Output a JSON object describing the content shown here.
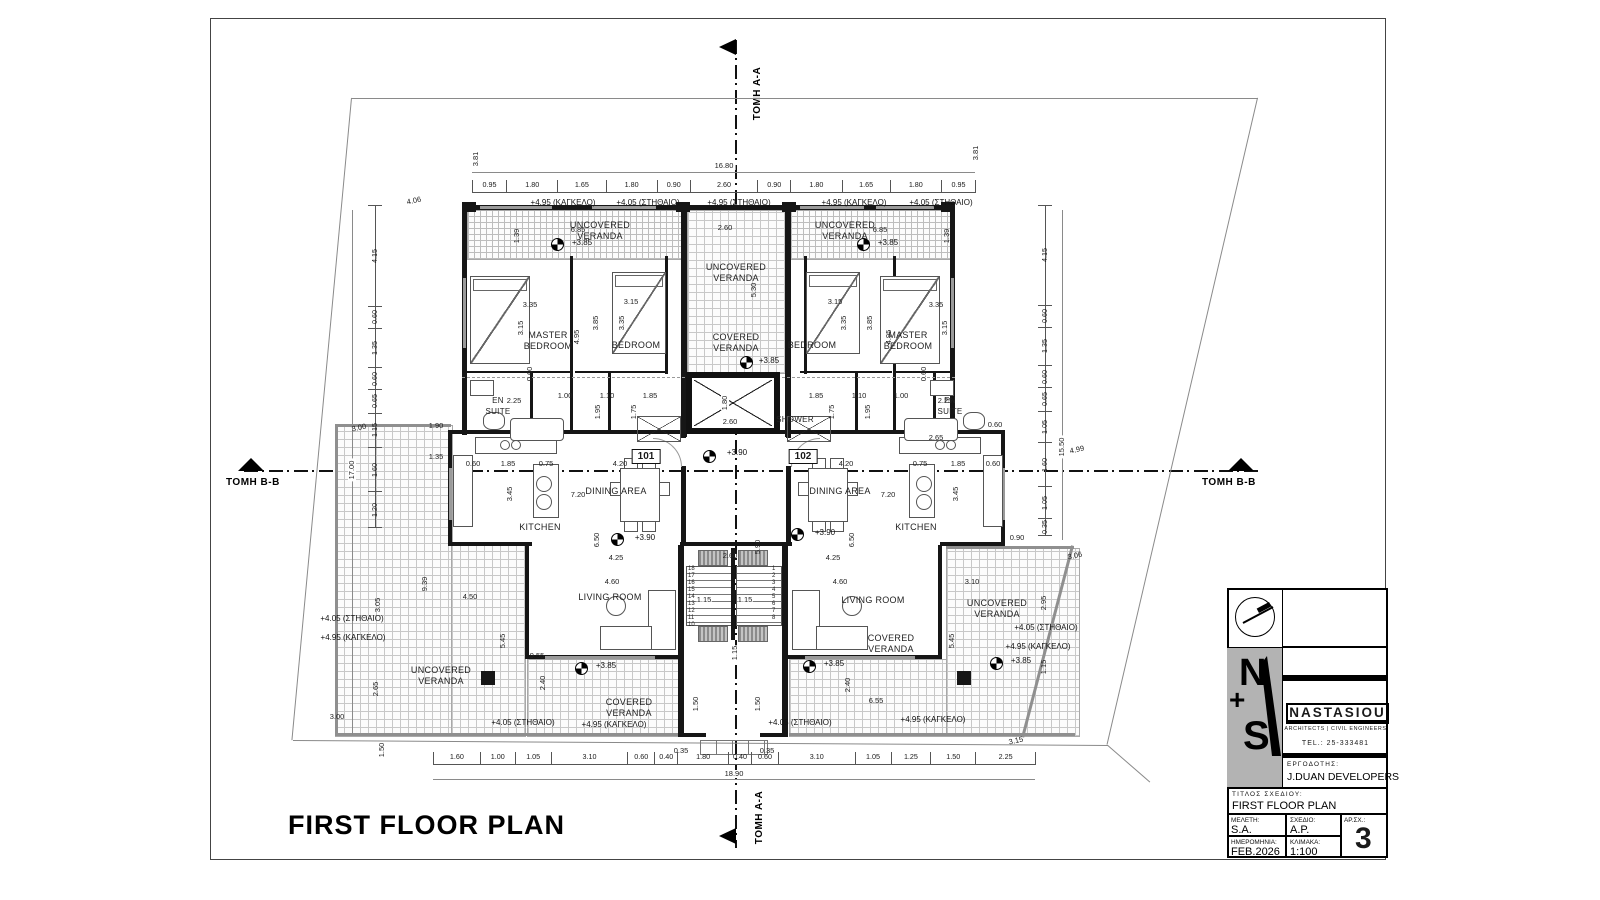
{
  "sheet": {
    "plan_title": "FIRST FLOOR PLAN",
    "section_aa": "TOMH A-A",
    "section_bb": "TOMH B-B"
  },
  "units": {
    "left": "101",
    "right": "102"
  },
  "rooms": {
    "master_bedroom": "MASTER\nBEDROOM",
    "bedroom": "BEDROOM",
    "en_suite": "EN\nSUITE",
    "shower": "SHOWER",
    "kitchen": "KITCHEN",
    "dining_area": "DINING AREA",
    "living_room": "LIVING ROOM",
    "uncovered_veranda": "UNCOVERED\nVERANDA",
    "covered_veranda": "COVERED\nVERANDA"
  },
  "levels": {
    "railing_495": "+4.95 (ΚΑΓΚΕΛΟ)",
    "parapet_405": "+4.05 (ΣΤΗΘΑΙΟ)",
    "parapet_495": "+4.95 (ΣΤΗΘΑΙΟ)",
    "lvl_385": "+3.85",
    "lvl_390": "+3.90"
  },
  "chains": {
    "top": [
      "0.95",
      "1.80",
      "1.65",
      "1.80",
      "0.90",
      "2.60",
      "0.90",
      "1.80",
      "1.65",
      "1.80",
      "0.95"
    ],
    "top_total": "16.80",
    "bottom": [
      "1.60",
      "1.00",
      "1.05",
      "3.10",
      "0.60",
      "0.40",
      "1.80",
      "0.40",
      "0.60",
      "3.10",
      "1.05",
      "1.25",
      "1.50",
      "2.25"
    ],
    "bottom_total": "18.90",
    "left": [
      "4.15",
      "0.60",
      "1.35",
      "0.60",
      "0.65",
      "1.15",
      "1.60",
      "1.20"
    ],
    "right": [
      "4.15",
      "0.60",
      "1.35",
      "0.60",
      "0.65",
      "1.05",
      "1.60",
      "1.05",
      "0.35"
    ]
  },
  "stairs": {
    "flight_down": [
      "18",
      "17",
      "16",
      "15",
      "14",
      "13",
      "12",
      "11",
      "10"
    ],
    "flight_up": [
      "1",
      "2",
      "3",
      "4",
      "5",
      "6",
      "7",
      "8"
    ]
  },
  "dims": {
    "d035": "0.35",
    "d060": "0.60",
    "d075": "0.75",
    "d090": "0.90",
    "d100": "1.00",
    "d110": "1.10",
    "d115": "1.15",
    "d135": "1.35",
    "d139": "1.39",
    "d150": "1.50",
    "d175": "1.75",
    "d180": "1.80",
    "d185": "1.85",
    "d190": "1.90",
    "d195": "1.95",
    "d225": "2.25",
    "d240": "2.40",
    "d260": "2.60",
    "d265": "2.65",
    "d295": "2.95",
    "d300": "3.00",
    "d305": "3.05",
    "d306": "3.06",
    "d310": "3.10",
    "d315": "3.15",
    "d335": "3.35",
    "d345": "3.45",
    "d381": "3.81",
    "d385": "3.85",
    "d406": "4.06",
    "d420": "4.20",
    "d425": "4.25",
    "d450": "4.50",
    "d460": "4.60",
    "d495": "4.95",
    "d499": "4.99",
    "d530": "5.30",
    "d545": "5.45",
    "d590": "5.90",
    "d650": "6.50",
    "d655": "6.55",
    "d685": "6.85",
    "d720": "7.20",
    "d939": "9.39",
    "d955": "9.55",
    "d1550": "15.50",
    "d1700": "17.00"
  },
  "title_block": {
    "logo_n": "N",
    "logo_plus": "+",
    "logo_s": "S",
    "firm_name": "NASTASIOU",
    "firm_subtitle": "ARCHITECTS | CIVIL ENGINEERS",
    "tel": "TEL.: 25-333481",
    "client_label": "ΕΡΓΟΔΟΤΗΣ:",
    "client_name": "J.DUAN DEVELOPERS",
    "title_label": "ΤΙΤΛΟΣ ΣΧΕΔΙΟΥ:",
    "title_value": "FIRST FLOOR PLAN",
    "study_label": "ΜΕΛΕΤΗ:",
    "study_value": "S.A.",
    "drawn_label": "ΣΧΕΔΙΟ:",
    "drawn_value": "A.P.",
    "sheet_no_label": "ΑΡ.ΣΧ.:",
    "sheet_no_value": "3",
    "date_label": "ΗΜΕΡΟΜΗΝΙΑ:",
    "date_value": "FEB.2026",
    "scale_label": "ΚΛΙΜΑΚΑ:",
    "scale_value": "1:100"
  }
}
